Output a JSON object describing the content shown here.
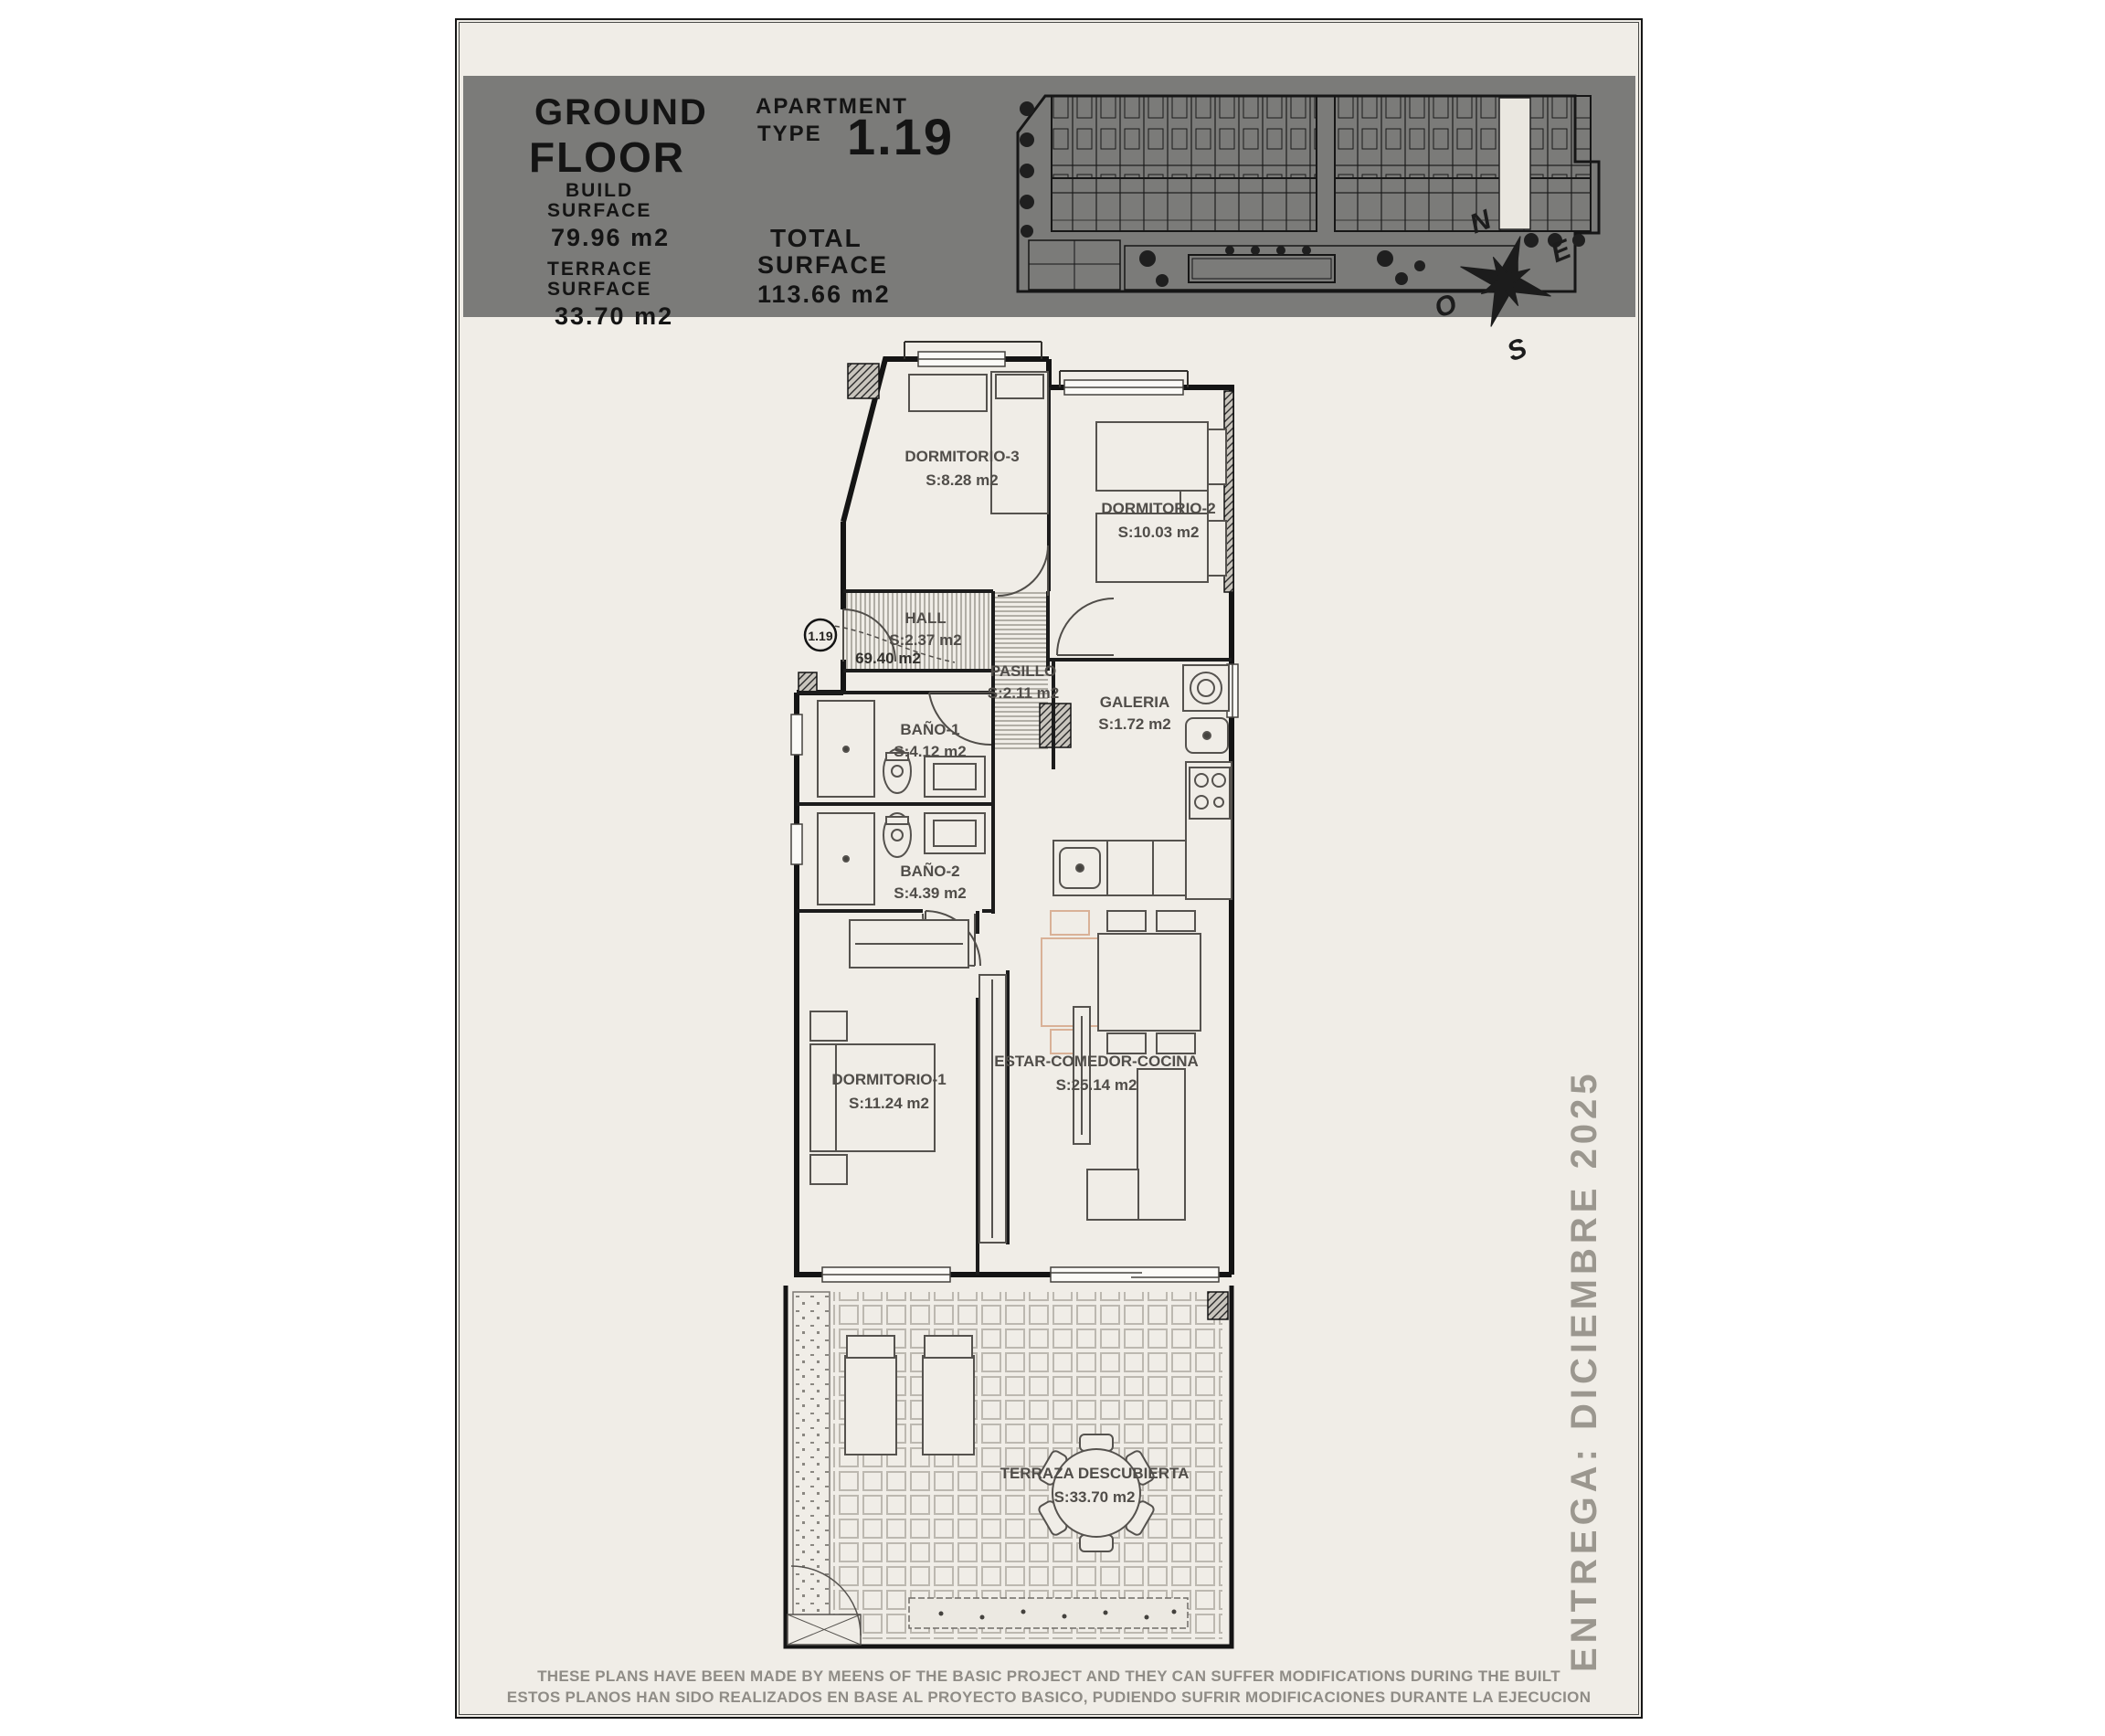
{
  "header": {
    "floor_line1": "GROUND",
    "floor_line2": "FLOOR",
    "apartment_label1": "APARTMENT",
    "apartment_label2": "TYPE",
    "apartment_number": "1.19",
    "build_surface_label1": "BUILD",
    "build_surface_label2": "SURFACE",
    "build_surface_value": "79.96 m2",
    "terrace_surface_label1": "TERRACE",
    "terrace_surface_label2": "SURFACE",
    "terrace_surface_value": "33.70 m2",
    "total_surface_label1": "TOTAL",
    "total_surface_label2": "SURFACE",
    "total_surface_value": "113.66 m2"
  },
  "compass": {
    "north": "N",
    "east": "E",
    "west": "O",
    "south": "S"
  },
  "plan": {
    "unit_badge": "1.19",
    "unit_area": "69.40 m2",
    "rooms": [
      {
        "name": "DORMITORIO-3",
        "area": "S:8.28 m2"
      },
      {
        "name": "DORMITORIO-2",
        "area": "S:10.03 m2"
      },
      {
        "name": "HALL",
        "area": "S:2.37 m2"
      },
      {
        "name": "PASILLO",
        "area": "S:2.11 m2"
      },
      {
        "name": "BAÑO-1",
        "area": "S:4.12 m2"
      },
      {
        "name": "GALERIA",
        "area": "S:1.72 m2"
      },
      {
        "name": "BAÑO-2",
        "area": "S:4.39 m2"
      },
      {
        "name": "DORMITORIO-1",
        "area": "S:11.24 m2"
      },
      {
        "name": "ESTAR-COMEDOR-COCINA",
        "area": "S:25.14 m2"
      },
      {
        "name": "TERRAZA DESCUBIERTA",
        "area": "S:33.70 m2"
      }
    ]
  },
  "sidebar_note": "ENTREGA: DICIEMBRE 2025",
  "disclaimer": {
    "line1": "THESE PLANS HAVE BEEN MADE BY MEENS OF THE BASIC PROJECT AND THEY CAN SUFFER MODIFICATIONS DURING THE BUILT",
    "line2": "ESTOS PLANOS HAN SIDO REALIZADOS EN BASE AL PROYECTO BASICO, PUDIENDO SUFRIR MODIFICACIONES DURANTE LA EJECUCION"
  },
  "colors": {
    "page_bg": "#f0ede7",
    "header_gray": "#7b7b79",
    "wall": "#141414",
    "accent_peach": "#d9b197",
    "label_gray": "#504d49",
    "muted_gray": "#8f8c86",
    "highlight_unit": "#eae7e0"
  }
}
